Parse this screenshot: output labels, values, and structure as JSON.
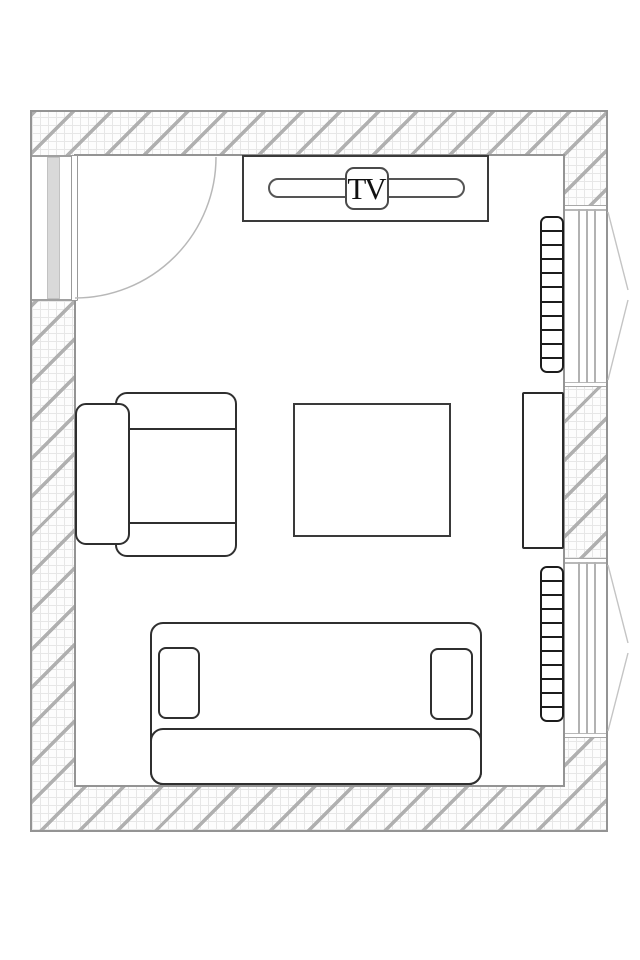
{
  "document": {
    "type": "floor-plan-diagram",
    "scene": "living room top-down plan with hatched walls"
  },
  "labels": {
    "tv": "TV"
  },
  "colors": {
    "background": "#ffffff",
    "wall_outline": "#949494",
    "wall_hatch": "#b0b0b0",
    "wall_grid": "#e7e7e7",
    "furniture_outline": "#2f2f2f",
    "radiator_outline": "#1c1c1c",
    "window_line": "#b2b2b2",
    "door_pocket_fill": "#d9d9d9",
    "swing_symbol": "#bdbdbd"
  },
  "objects": [
    "door",
    "door-swing-arc",
    "tv-stand",
    "tv",
    "radiator-top",
    "window-top",
    "cabinet",
    "radiator-bottom",
    "window-bottom",
    "armchair",
    "coffee-table",
    "sofa"
  ],
  "radiators": {
    "top": {
      "segments": 11
    },
    "bottom": {
      "segments": 11
    }
  }
}
